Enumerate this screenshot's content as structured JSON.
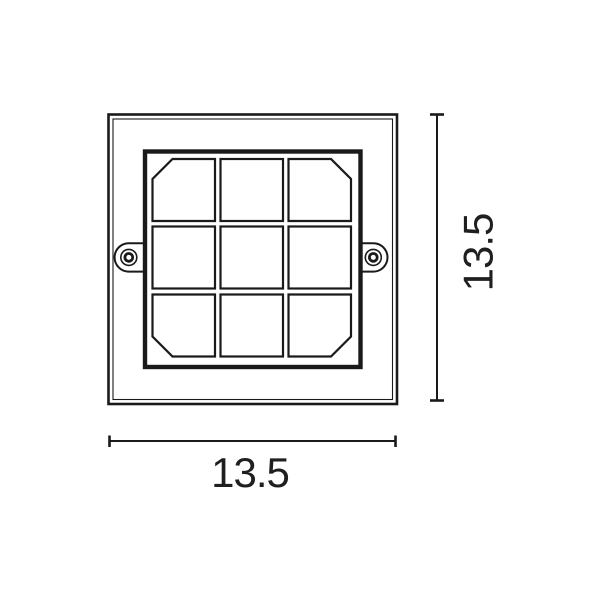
{
  "drawing": {
    "type": "technical-dimension-drawing",
    "subject": "square recessed light fixture, front view",
    "dimension_width": "13.5",
    "dimension_height": "13.5",
    "grid": {
      "rows": 3,
      "cols": 3
    },
    "mounting_screws": 2,
    "colors": {
      "line": "#1a1a1a",
      "text": "#1f1f1f",
      "background": "#ffffff"
    }
  }
}
